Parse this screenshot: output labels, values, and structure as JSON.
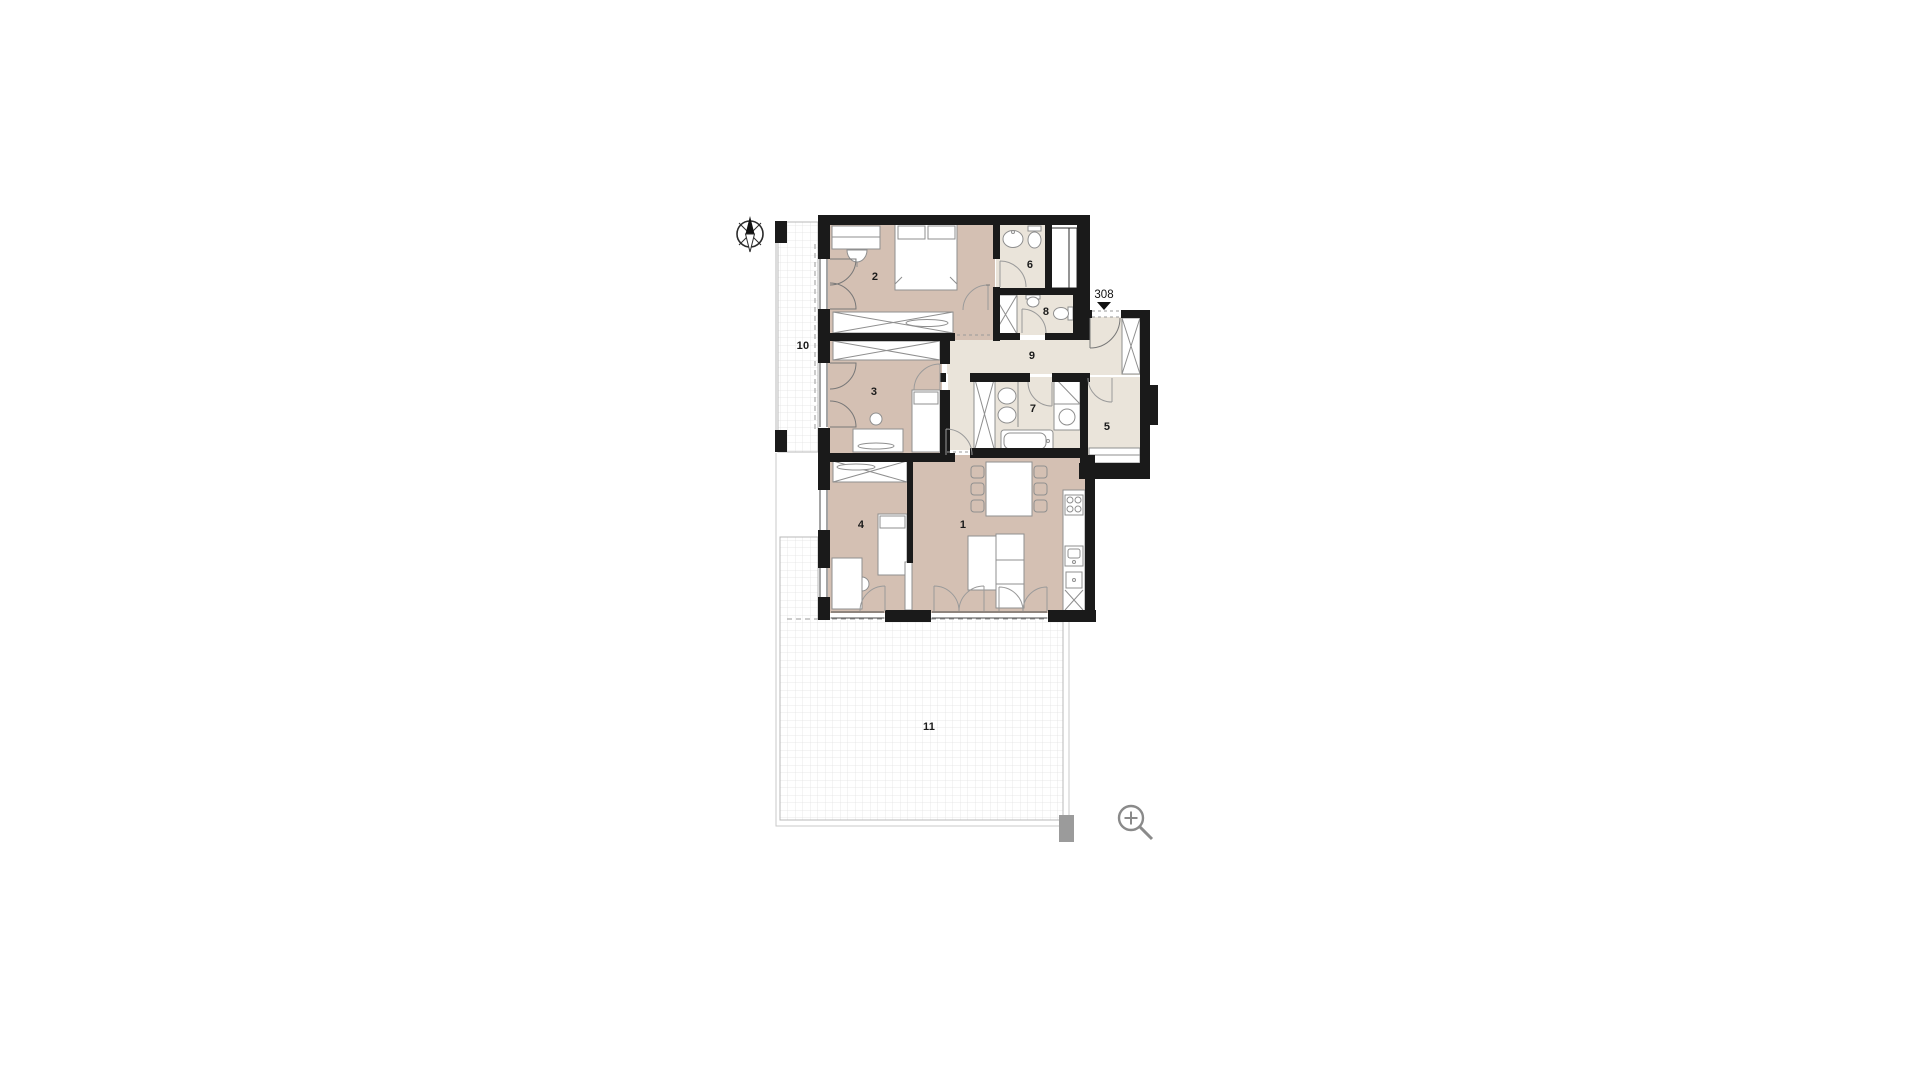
{
  "floorplan": {
    "unit_number": "308",
    "rooms": [
      {
        "number": "1",
        "kind": "living-room-kitchen"
      },
      {
        "number": "2",
        "kind": "bedroom"
      },
      {
        "number": "3",
        "kind": "bedroom"
      },
      {
        "number": "4",
        "kind": "bedroom"
      },
      {
        "number": "5",
        "kind": "storage-room"
      },
      {
        "number": "6",
        "kind": "bathroom"
      },
      {
        "number": "7",
        "kind": "bathroom"
      },
      {
        "number": "8",
        "kind": "wc"
      },
      {
        "number": "9",
        "kind": "hallway"
      },
      {
        "number": "10",
        "kind": "balcony"
      },
      {
        "number": "11",
        "kind": "terrace"
      }
    ]
  },
  "icons": {
    "compass": "north-arrow",
    "zoom": "zoom-in-magnifier",
    "entrance_marker": "triangle-down"
  },
  "colors": {
    "room_floor": "#d4c0b3",
    "wet_floor": "#eae4da",
    "wall": "#1a1a1a",
    "furniture_line": "#8f8f8f",
    "grid_line": "#e2e2e2",
    "rail_line": "#b8b8b8",
    "icon_gray": "#8a8a8a"
  }
}
